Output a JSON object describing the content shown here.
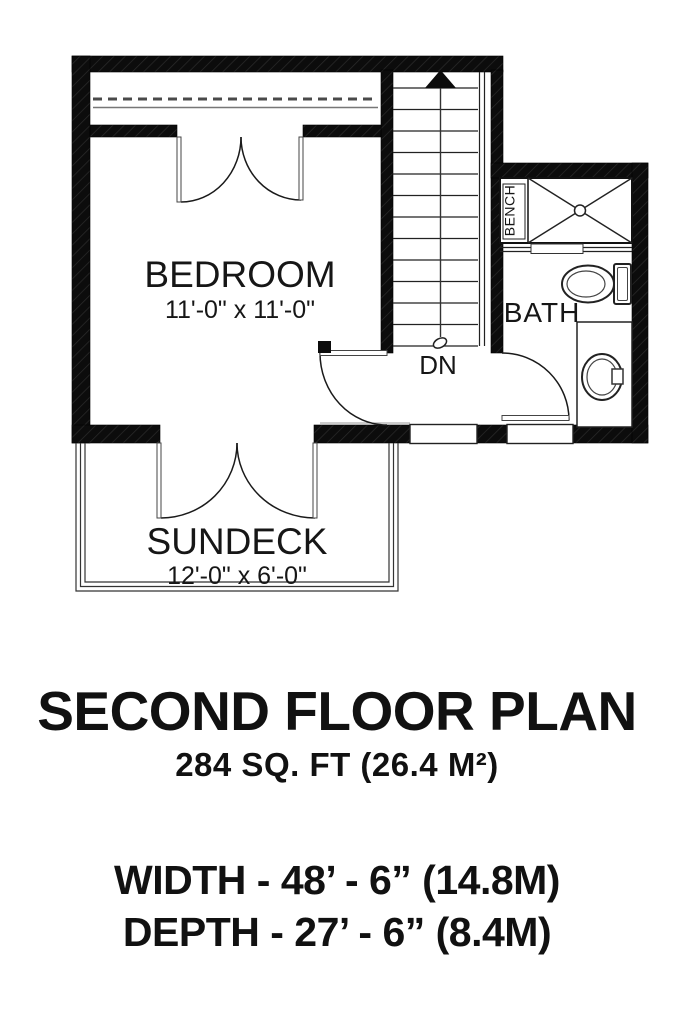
{
  "document": {
    "plan": {
      "bedroom": {
        "label": "BEDROOM",
        "dims": "11'-0\" x 11'-0\""
      },
      "sundeck": {
        "label": "SUNDECK",
        "dims": "12'-0\" x 6'-0\""
      },
      "bath": {
        "label": "BATH"
      },
      "shower": {
        "bench_label": "BENCH"
      },
      "stairs": {
        "down_label": "DN"
      }
    },
    "title_block": {
      "title": "SECOND FLOOR PLAN",
      "area": "284 SQ. FT (26.4 M²)",
      "width": "WIDTH - 48’ - 6” (14.8M)",
      "depth": "DEPTH - 27’ - 6” (8.4M)"
    },
    "colors": {
      "ink": "#111111",
      "paper": "#ffffff"
    }
  }
}
